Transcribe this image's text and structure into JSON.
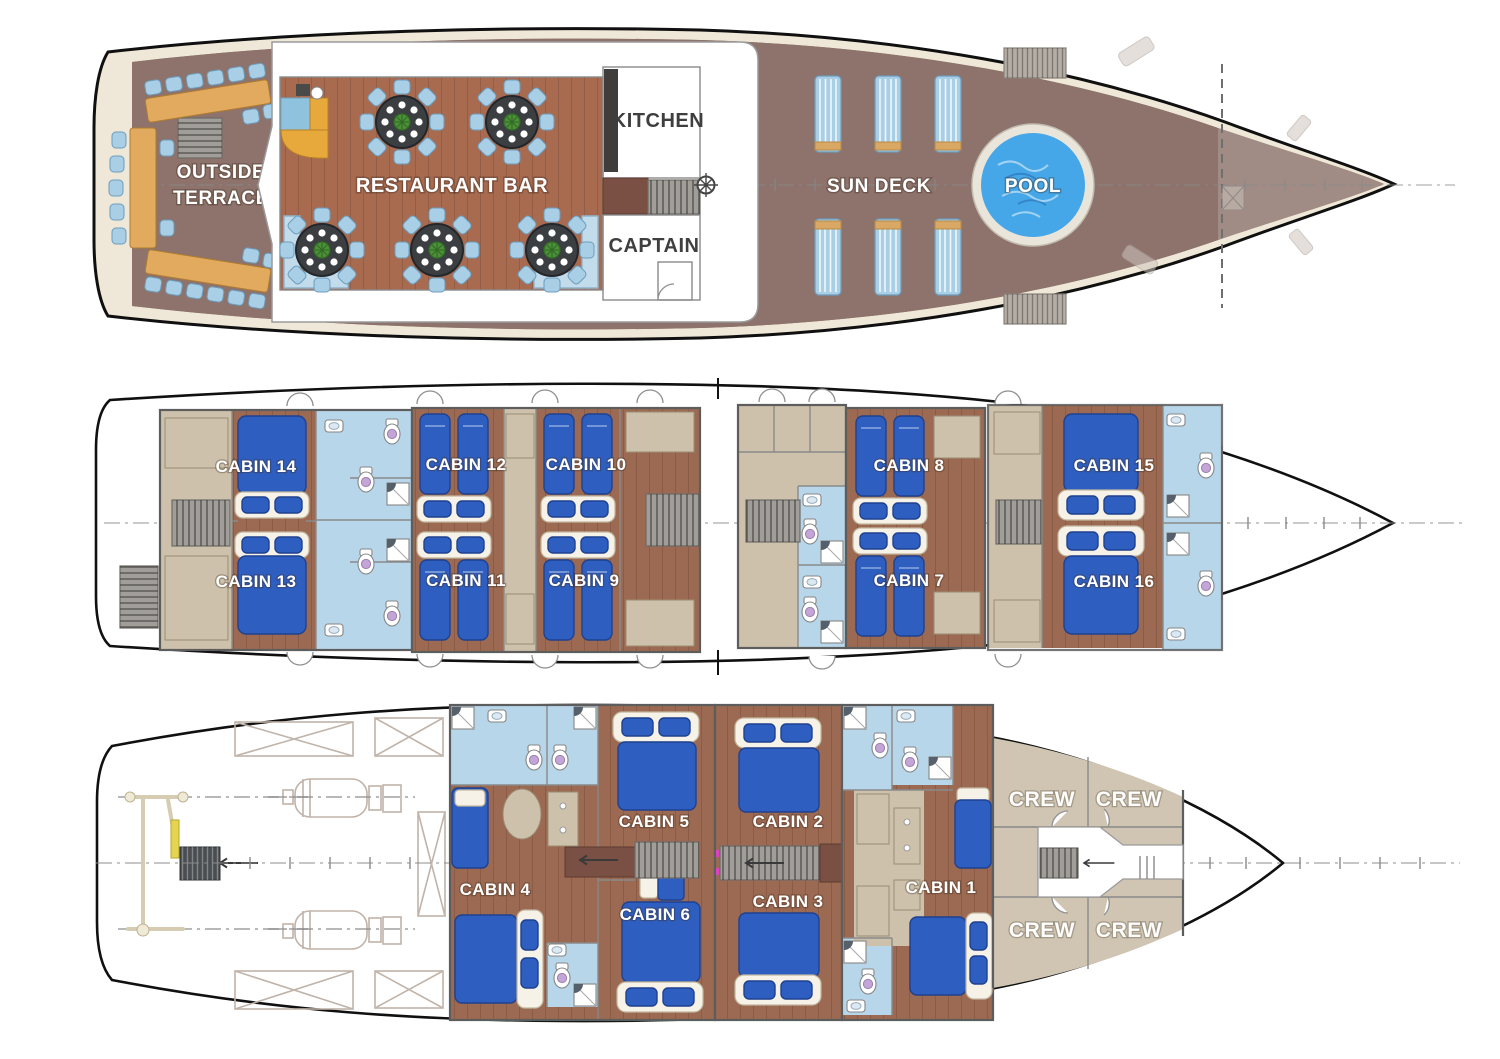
{
  "title": "Yacht deck plans",
  "palette": {
    "hull_outline": "#101010",
    "platform_cream": "#efe8d8",
    "deck_wood": "#8d736b",
    "floor_red": "#a86b50",
    "cabin_floor": "#9c6a52",
    "bath_blue": "#b7d6ea",
    "bed_blue": "#2e5fc0",
    "bed_dark": "#1f418f",
    "linen_white": "#f6f2e8",
    "wall_gray": "#8a8a8a",
    "tan": "#cdc1ab",
    "crew_tan": "#cfc5b2",
    "pool_blue": "#45a7e8",
    "chair_blue": "#a9cfe6",
    "chair_edge": "#6d9cbc",
    "table_dark": "#3c3f42",
    "bar_yellow": "#e8a93c",
    "bar_blue": "#8fc3dd",
    "lounger_tan": "#d9a864",
    "stair_gray": "#a19d98",
    "landing_brown": "#7b5044",
    "plant_green": "#4e8f3a",
    "engine_line": "#c0b3a9",
    "centerline": "#8a8a8a",
    "label_white": "#ffffff",
    "label_dark": "#3f3f3f"
  },
  "decks": {
    "main": {
      "labels": {
        "terrace1": "OUTSIDE",
        "terrace2": "TERRACE",
        "restaurant": "RESTAURANT BAR",
        "kitchen": "KITCHEN",
        "captain": "CAPTAIN",
        "sundeck": "SUN DECK",
        "pool": "POOL"
      }
    },
    "cabin": {
      "cabins": [
        {
          "label": "CABIN 14"
        },
        {
          "label": "CABIN 13"
        },
        {
          "label": "CABIN 12"
        },
        {
          "label": "CABIN 11"
        },
        {
          "label": "CABIN 10"
        },
        {
          "label": "CABIN 9"
        },
        {
          "label": "CABIN 8"
        },
        {
          "label": "CABIN 7"
        },
        {
          "label": "CABIN 15"
        },
        {
          "label": "CABIN 16"
        }
      ]
    },
    "lower": {
      "cabins": [
        {
          "label": "CABIN 5"
        },
        {
          "label": "CABIN 4"
        },
        {
          "label": "CABIN 6"
        },
        {
          "label": "CABIN 2"
        },
        {
          "label": "CABIN 3"
        },
        {
          "label": "CABIN 1"
        }
      ],
      "crew": [
        {
          "label": "CREW"
        },
        {
          "label": "CREW"
        },
        {
          "label": "CREW"
        },
        {
          "label": "CREW"
        }
      ]
    }
  }
}
